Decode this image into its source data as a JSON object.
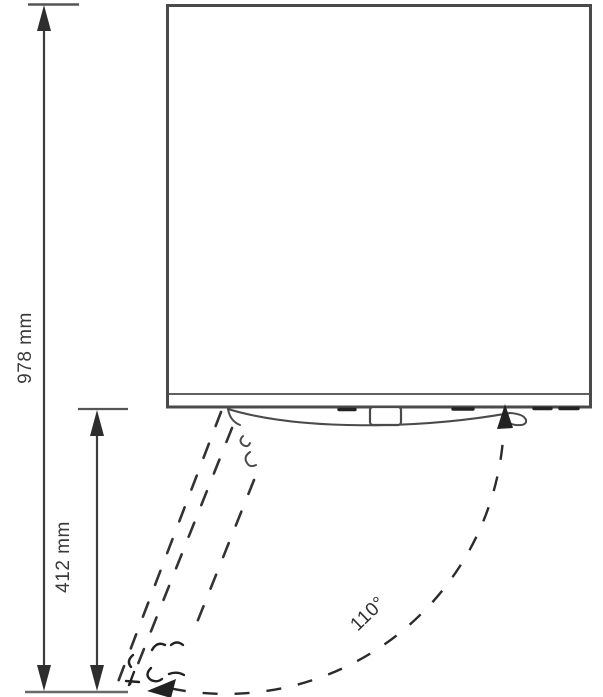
{
  "figure": {
    "kind": "appliance-door-swing-dimension-diagram",
    "view": "top-view-with-door-arc",
    "dimensions": [
      {
        "id": "overall-depth",
        "label": "978 mm",
        "value": 978,
        "unit": "mm",
        "orientation": "vertical"
      },
      {
        "id": "door-projection",
        "label": "412 mm",
        "value": 412,
        "unit": "mm",
        "orientation": "vertical"
      }
    ],
    "angle": {
      "id": "door-opening-angle",
      "label": "110°",
      "value": 110,
      "unit": "degrees"
    },
    "colors": {
      "line": "#4a4a4a",
      "dimension_line": "#3d3d3d",
      "dashed_line": "#2e2e2e",
      "text": "#3a3a3a",
      "background": "#ffffff"
    }
  }
}
